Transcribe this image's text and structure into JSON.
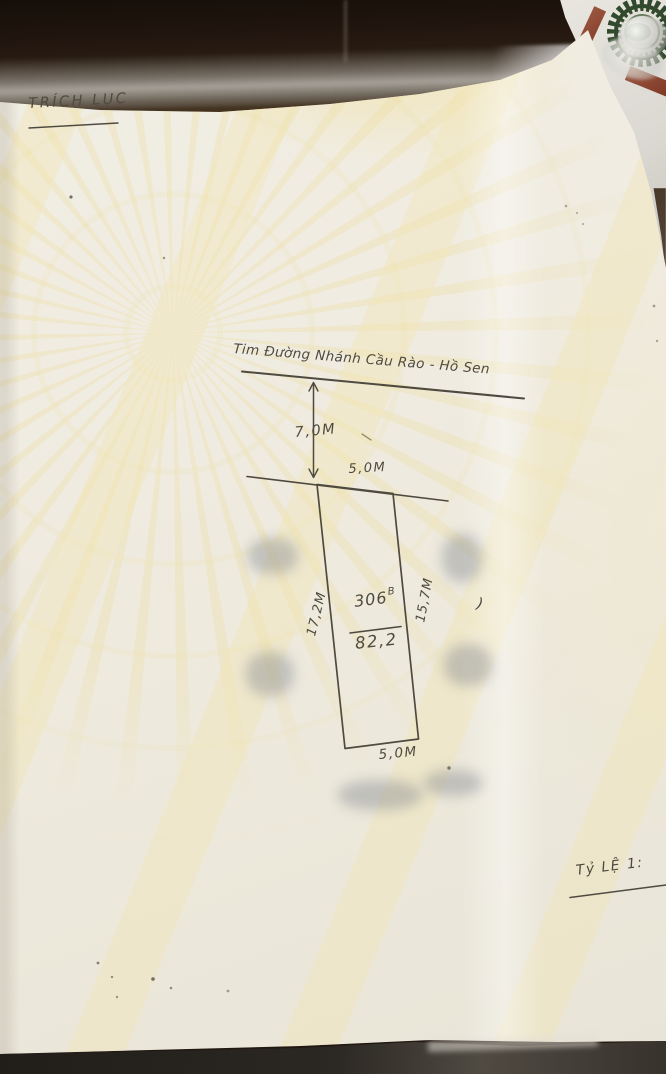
{
  "document": {
    "title": "TRÍCH LỤC",
    "road_label": "Tim Đường Nhánh Cầu Rào - Hồ Sen",
    "scale_label": "Tỷ LỆ 1:",
    "stray_mark": ")"
  },
  "plot": {
    "parcel_number": "306",
    "parcel_suffix": "B",
    "area_value": "82,2",
    "dim_road_to_plot": "7,0M",
    "dim_front_width": "5,0M",
    "dim_left_side": "17,2M",
    "dim_right_side": "15,7M",
    "dim_back_width": "5,0M"
  },
  "colors": {
    "ink": "#4f4a40",
    "paper": "#efebe0",
    "watermark_yellow": "#f2e4ac",
    "desk_dark": "#2d2013",
    "seal_green": "#31492c",
    "frame_maroon": "#8a4430"
  }
}
